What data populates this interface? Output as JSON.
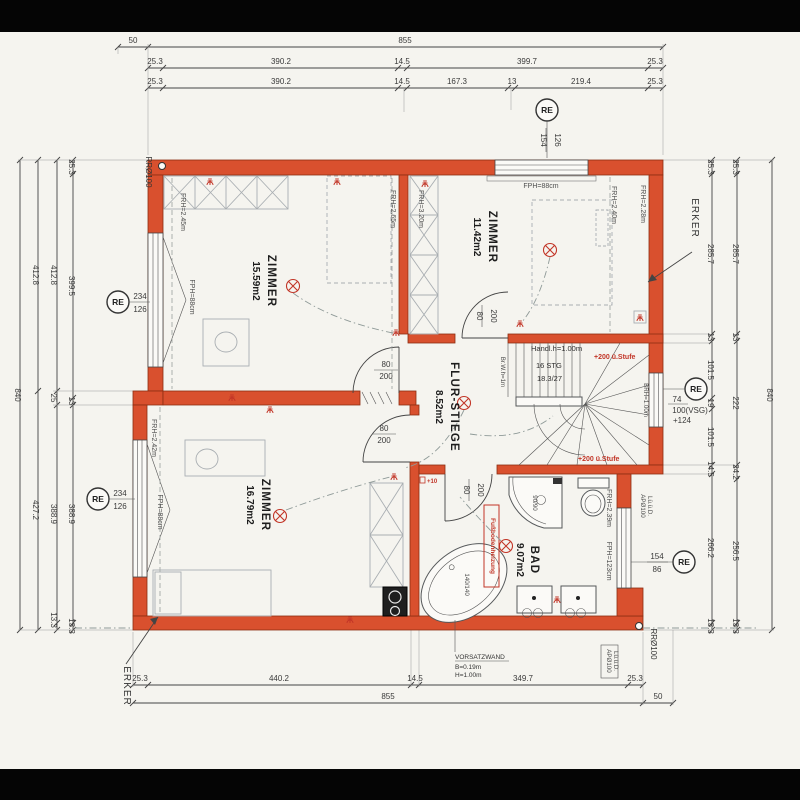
{
  "colors": {
    "paper": "#f5f4ef",
    "band": "#050505",
    "wall_fill": "#d9502e",
    "wall_edge": "#8c2d12",
    "annotation_red": "#c23527",
    "drawing_line": "#444444"
  },
  "rooms": {
    "zimmer_tl": {
      "name": "ZIMMER",
      "area": "15.59m2"
    },
    "zimmer_tr": {
      "name": "ZIMMER",
      "area": "11.42m2"
    },
    "zimmer_bl": {
      "name": "ZIMMER",
      "area": "16.79m2"
    },
    "flur": {
      "name": "FLUR-STIEGE",
      "area": "8.52m2"
    },
    "bad": {
      "name": "BAD",
      "area": "9.07m2"
    }
  },
  "dims": {
    "top1": [
      "50",
      "855"
    ],
    "top2": [
      "25.3",
      "390.2",
      "14.5",
      "399.7",
      "25.3"
    ],
    "top3": [
      "25.3",
      "390.2",
      "14.5",
      "167.3",
      "13",
      "219.4",
      "25.3"
    ],
    "bottom1": [
      "25.3",
      "440.2",
      "14.5",
      "349.7",
      "25.3"
    ],
    "bottom2": [
      "855"
    ],
    "bottom3": [
      "50"
    ],
    "left1": [
      "25.3",
      "399.5",
      "13",
      "388.9",
      "13.3"
    ],
    "left2": [
      "412.8",
      "25",
      "388.9",
      "13.3"
    ],
    "left3": [
      "412.8",
      "427.2"
    ],
    "left4": [
      "840"
    ],
    "right1": [
      "25.3",
      "285.7",
      "13",
      "101.5",
      "19",
      "101.5",
      "14.5",
      "266.2",
      "13.3"
    ],
    "right2": [
      "25.3",
      "285.7",
      "13",
      "222",
      "24.2",
      "256.5",
      "13.3"
    ],
    "right3": [
      "840"
    ]
  },
  "windows": {
    "top": {
      "num": "154",
      "den": "126"
    },
    "left": {
      "num": "234",
      "den": "126"
    },
    "stair": {
      "l1": "74",
      "l2": "100(VSG)",
      "l3": "+124"
    },
    "bad": {
      "num": "154",
      "den": "86"
    }
  },
  "door": {
    "num": "80",
    "den": "200"
  },
  "heights": {
    "fph88": "FPH=88cm",
    "tl_left": "FRH=2.45m",
    "tl_right": "FRH=2.65m",
    "tr_left": "FRH=3.20m",
    "tr_mid": "FRH=2.40m",
    "tr_bay": "FRH=2.28m",
    "bl_left": "FRH=2.42m",
    "bad": "FRH=2.39m",
    "bad_sill": "FPH=123cm"
  },
  "stairs": {
    "handrail": "Handl.h=1.00m",
    "count": "16 STG",
    "rise_run": "18.3/27",
    "step_note": "+200 ü.Stufe",
    "width": "Br.W.h=1m",
    "parapet": "BRH=1.00m"
  },
  "labels": {
    "re": "RE",
    "erker": "ERKER",
    "rr_pipe": "RRØ100",
    "ap_pipe": "APØ100",
    "ap_pipe2": "Lü.ü.D.",
    "vorsatzwand_1": "VORSATZWAND",
    "vorsatzwand_2": "B=0.19m",
    "vorsatzwand_3": "H=1.00m",
    "floor_heating": "Fußbodenheizung",
    "plus10": "+10",
    "shower_size": "90/90",
    "tub_size": "140/140"
  }
}
